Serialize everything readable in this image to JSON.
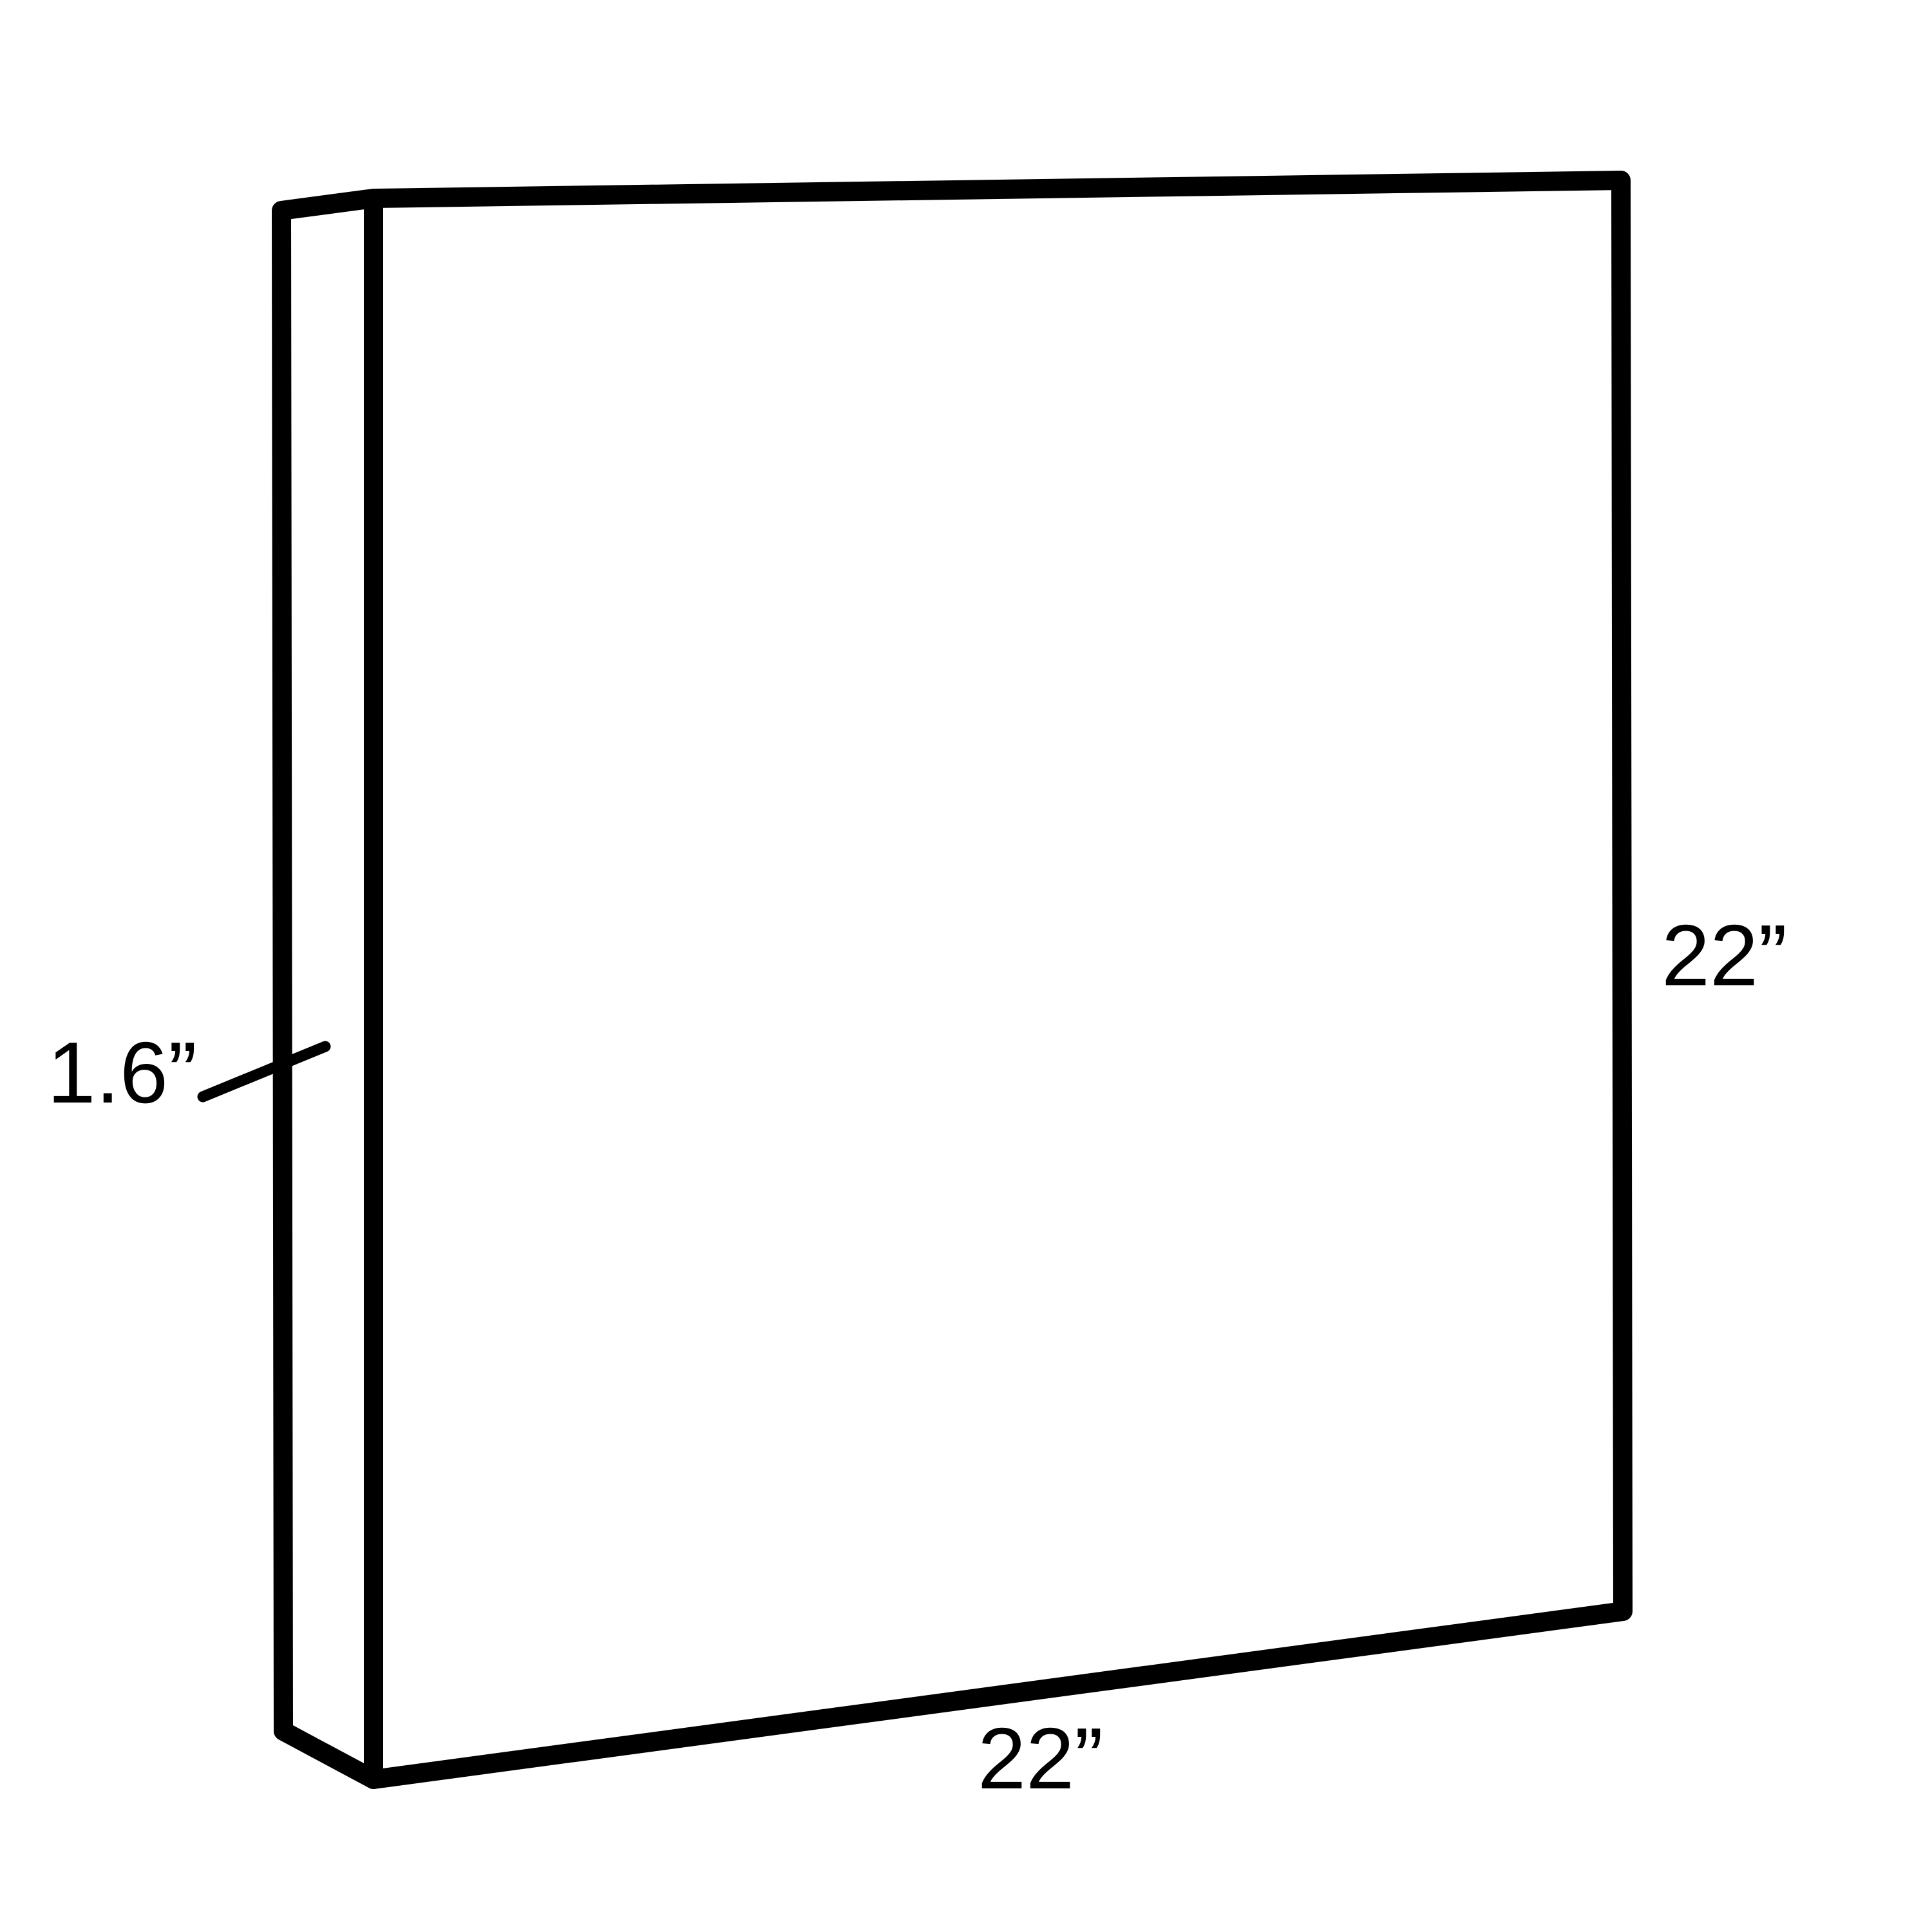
{
  "diagram": {
    "type": "dimension-drawing",
    "subject": "thin rectangular panel shown in perspective with depth edge on the left",
    "labels": {
      "depth": "1.6”",
      "height": "22”",
      "width": "22”"
    },
    "colors": {
      "line": "#000000",
      "background": "#ffffff"
    }
  }
}
